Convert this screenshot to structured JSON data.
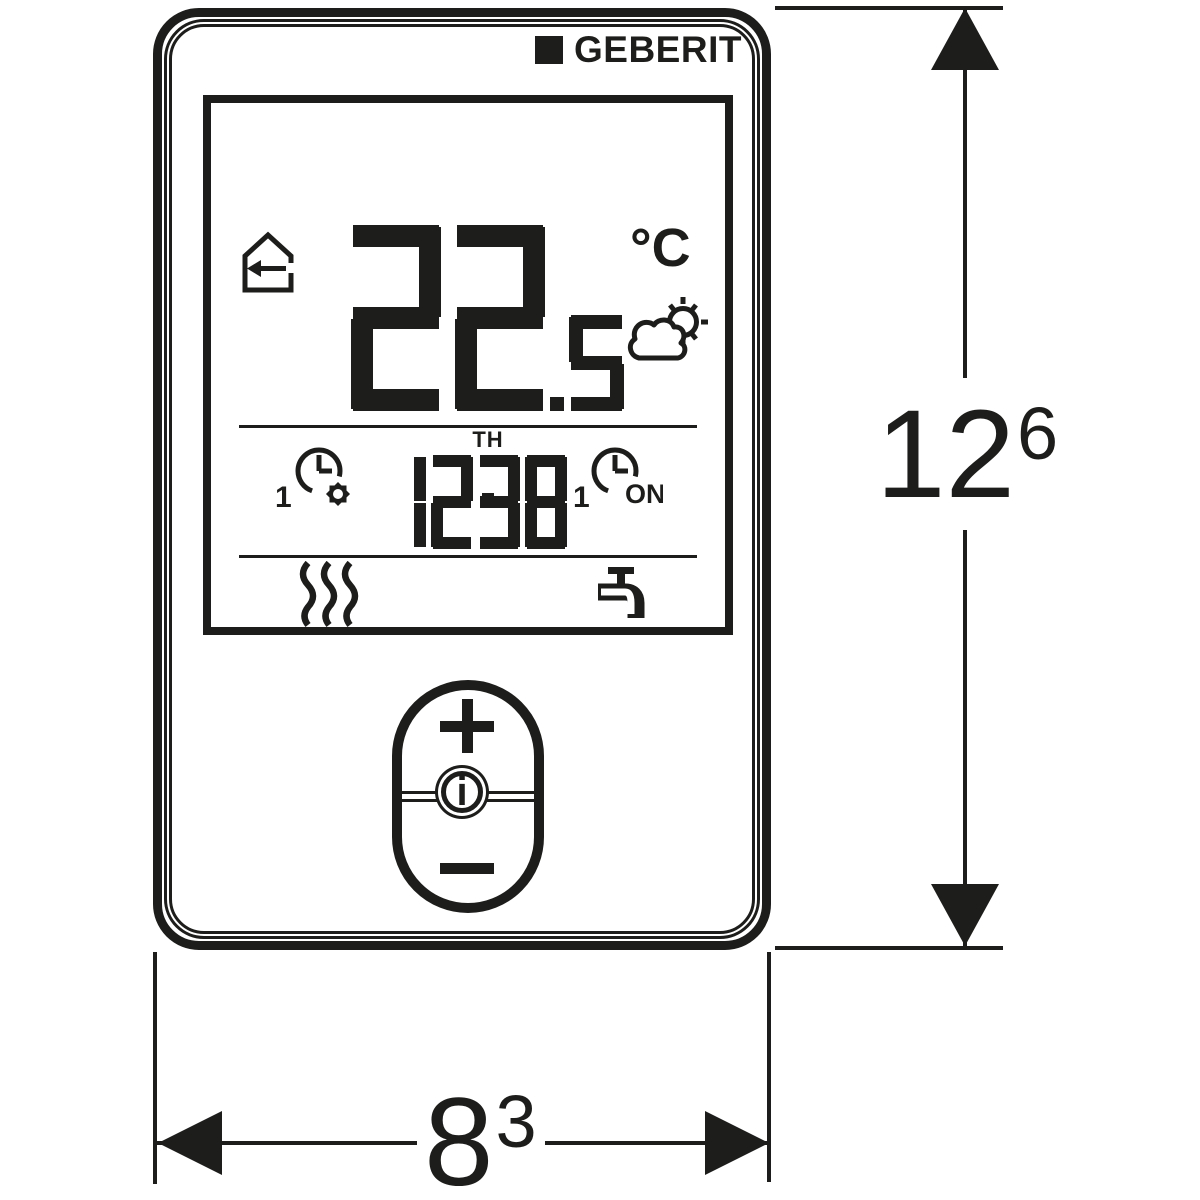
{
  "brand": {
    "name": "GEBERIT"
  },
  "display": {
    "mode_icon": "house-arrow-left-icon",
    "temperature": {
      "integer": "22",
      "fraction": ".5",
      "unit": "°C"
    },
    "weather_icon": "sun-behind-cloud-icon",
    "day": "TH",
    "time": "12:38",
    "left_timer": {
      "index": "1",
      "icon": "clock-comfort-gear-icon"
    },
    "right_timer": {
      "index": "1",
      "icon": "clock-timer-icon",
      "label": "ON"
    },
    "status_icons": {
      "left": "heating-waves-icon",
      "right": "water-tap-icon"
    }
  },
  "controls": {
    "plus_label": "+",
    "info_label": "i",
    "minus_label": "−"
  },
  "dimensions": {
    "height": {
      "value": "12",
      "superscript": "6"
    },
    "width": {
      "value": "8",
      "superscript": "3"
    }
  },
  "colors": {
    "ink": "#1d1d1b",
    "background": "#ffffff"
  }
}
